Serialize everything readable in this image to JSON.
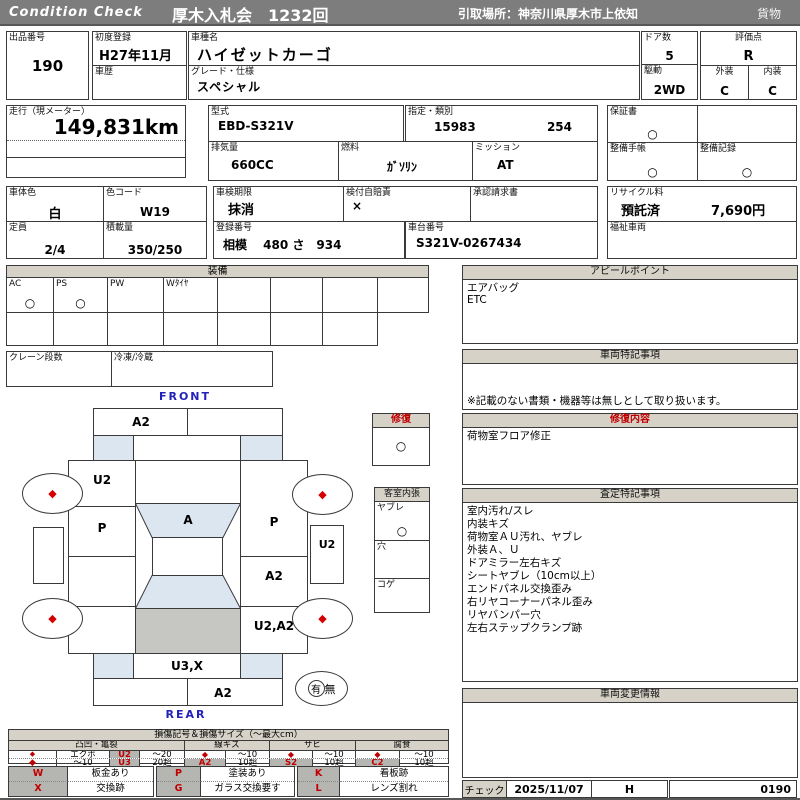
{
  "header": {
    "brand": "Condition  Check",
    "auction": "厚木入札会　1232回",
    "pickup": "引取場所：神奈川県厚木市上依知",
    "category": "貨物"
  },
  "info": {
    "lot_label": "出品番号",
    "lot": "190",
    "first_reg_label": "初度登録",
    "first_reg": "H27年11月",
    "history_label": "車歴",
    "model_name_label": "車種名",
    "model_name": "ハイゼットカーゴ",
    "grade_label": "グレード・仕様",
    "grade": "スペシャル",
    "doors_label": "ドア数",
    "doors": "5",
    "drive_label": "駆動",
    "drive": "2WD",
    "score_label": "評価点",
    "score": "R",
    "exterior_label": "外装",
    "exterior": "C",
    "interior_label": "内装",
    "interior": "C",
    "mileage_label": "走行（現メーター）",
    "mileage": "149,831km",
    "model_code_label": "型式",
    "model_code": "EBD-S321V",
    "type_label": "指定・類別",
    "type_no1": "15983",
    "type_no2": "254",
    "displacement_label": "排気量",
    "displacement": "660CC",
    "fuel_label": "燃料",
    "fuel": "ｶﾞｿﾘﾝ",
    "transmission_label": "ミッション",
    "transmission": "AT",
    "warranty_label": "保証書",
    "warranty": "○",
    "maintenance_book_label": "整備手帳",
    "maintenance_book": "○",
    "maintenance_record_label": "整備記録",
    "maintenance_record": "○",
    "body_color_label": "車体色",
    "body_color": "白",
    "color_code_label": "色コード",
    "color_code": "W19",
    "capacity_label": "定員",
    "capacity": "2/4",
    "load_label": "積載量",
    "load": "350/250",
    "inspection_label": "車検期限",
    "inspection": "抹消",
    "insurance_label": "検付自賠責",
    "insurance": "×",
    "approval_label": "承認請求書",
    "recycle_label": "リサイクル料",
    "recycle_status": "預託済",
    "recycle_fee": "7,690円",
    "reg_no_label": "登録番号",
    "reg_no": "相模　 480 さ　934",
    "chassis_label": "車台番号",
    "chassis": "S321V-0267434",
    "welfare_label": "福祉車両"
  },
  "equipment": {
    "title": "装備",
    "row1": [
      {
        "label": "AC",
        "mark": "○"
      },
      {
        "label": "PS",
        "mark": "○"
      },
      {
        "label": "PW",
        "mark": ""
      },
      {
        "label": "Wﾀｲﾔ",
        "mark": ""
      },
      {
        "label": "",
        "mark": ""
      },
      {
        "label": "",
        "mark": ""
      },
      {
        "label": "",
        "mark": ""
      },
      {
        "label": "",
        "mark": ""
      }
    ],
    "crane_label": "クレーン段数",
    "cold_label": "冷凍/冷蔵"
  },
  "appeal": {
    "title": "アピールポイント",
    "lines": [
      "エアバッグ",
      "ETC"
    ]
  },
  "vehicle_notes": {
    "title": "車両特記事項",
    "note": "※記載のない書類・機器等は無しとして取り扱います。"
  },
  "repair": {
    "title": "修復内容",
    "lines": [
      "荷物室フロア修正"
    ]
  },
  "assessment": {
    "title": "査定特記事項",
    "lines": [
      "室内汚れ/スレ",
      "内装キズ",
      "荷物室ＡＵ汚れ、ヤブレ",
      "外装Ａ、Ｕ",
      "ドアミラー左右キズ",
      "シートヤブレ（10cm以上）",
      "エンドパネル交換歪み",
      "右リヤコーナーパネル歪み",
      "リヤバンパー穴",
      "左右ステップクランプ跡"
    ]
  },
  "change_info": {
    "title": "車両変更情報"
  },
  "check": {
    "label": "チェック",
    "date": "2025/11/07",
    "inspector": "H",
    "number": "0190"
  },
  "diagram": {
    "front_label": "FRONT",
    "rear_label": "REAR",
    "repair_box": {
      "label": "修復",
      "mark": "○"
    },
    "cabin_box": {
      "label": "客室内張",
      "rows": [
        {
          "label": "ヤブレ",
          "mark": "○"
        },
        {
          "label": "穴",
          "mark": ""
        },
        {
          "label": "コゲ",
          "mark": ""
        }
      ]
    },
    "spare": {
      "has": "有",
      "none": "無"
    },
    "wheel_mark": "◆",
    "marks": {
      "front_bumper": "A2",
      "left_fender": "U2",
      "left_door": "P",
      "windshield": "A",
      "right_door": "P",
      "right_slide_door": "A2",
      "right_side_step": "U2",
      "right_quarter": "U2,A2",
      "rear_panel": "U3,X",
      "rear_bumper": "A2"
    }
  },
  "legend": {
    "title": "損傷記号＆損傷サイズ（～最大cm）",
    "groups": [
      {
        "name": "凸凹・亀裂",
        "rows": [
          [
            "◆",
            "エクボ",
            "U2",
            "～20"
          ],
          [
            "◆",
            "～10",
            "U3",
            "20超"
          ]
        ]
      },
      {
        "name": "線キズ",
        "rows": [
          [
            "◆",
            "～10"
          ],
          [
            "A2",
            "10超"
          ]
        ]
      },
      {
        "name": "サビ",
        "rows": [
          [
            "◆",
            "～10"
          ],
          [
            "S2",
            "10超"
          ]
        ]
      },
      {
        "name": "腐食",
        "rows": [
          [
            "◆",
            "～10"
          ],
          [
            "C2",
            "10超"
          ]
        ]
      }
    ],
    "codes": [
      [
        {
          "code": "W",
          "desc": "板金あり"
        },
        {
          "code": "X",
          "desc": "交換跡"
        }
      ],
      [
        {
          "code": "P",
          "desc": "塗装あり"
        },
        {
          "code": "G",
          "desc": "ガラス交換要す"
        }
      ],
      [
        {
          "code": "K",
          "desc": "看板跡"
        },
        {
          "code": "L",
          "desc": "レンズ割れ"
        }
      ]
    ]
  },
  "colors": {
    "accent_red": "#c00000",
    "header_gray": "#7d7d7d",
    "panel_gray": "#d6d2c8",
    "cell_gray": "#b5b5b2",
    "diagram_blue": "#dce6f1",
    "diagram_gray": "#c6c6c2",
    "front_rear_blue": "#2222bb"
  }
}
